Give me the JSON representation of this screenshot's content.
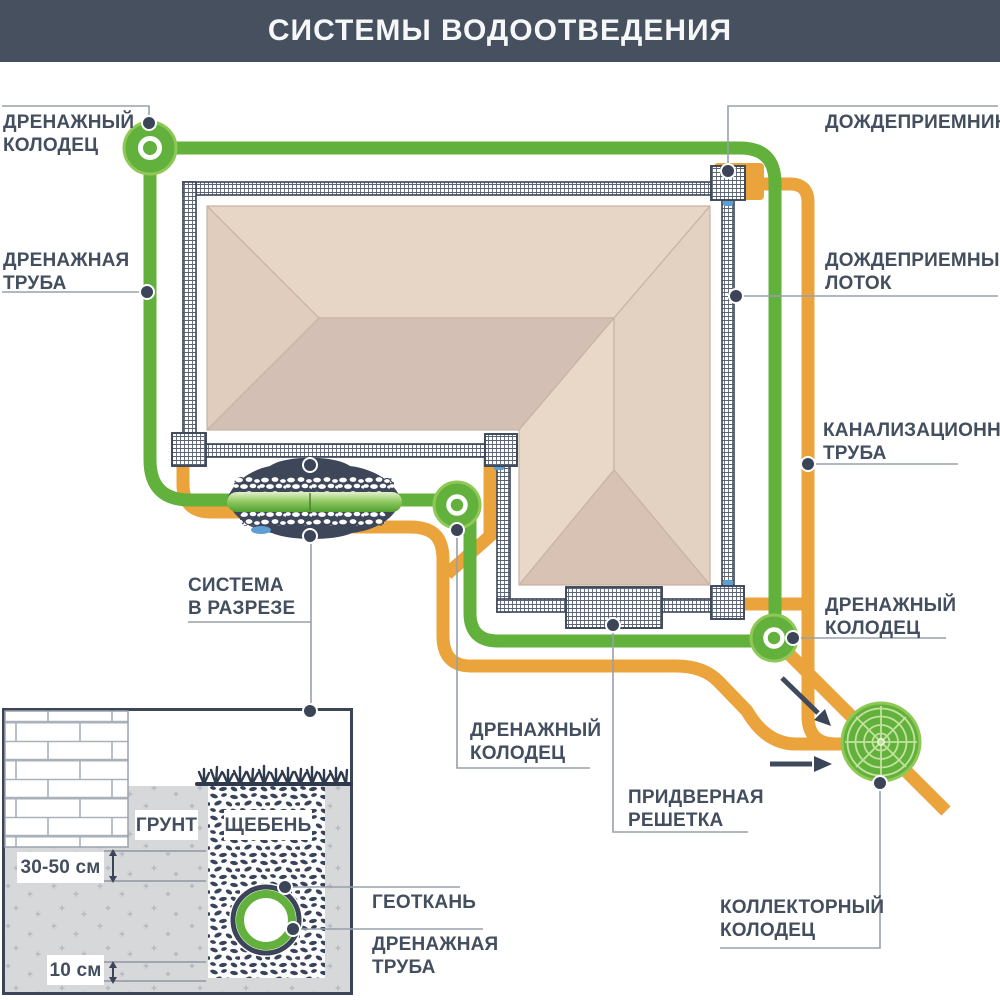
{
  "title": "СИСТЕМЫ ВОДООТВЕДЕНИЯ",
  "labels": {
    "drainage_well_top_left": "ДРЕНАЖНЫЙ\nКОЛОДЕЦ",
    "drainage_pipe_left": "ДРЕНАЖНАЯ\nТРУБА",
    "rain_inlet": "ДОЖДЕПРИЕМНИК",
    "rain_tray": "ДОЖДЕПРИЕМНЫЙ\nЛОТОК",
    "sewer_pipe": "КАНАЛИЗАЦИОННАЯ\nТРУБА",
    "drainage_well_right": "ДРЕНАЖНЫЙ\nКОЛОДЕЦ",
    "system_in_section": "СИСТЕМА\nВ РАЗРЕЗЕ",
    "drainage_well_middle": "ДРЕНАЖНЫЙ\nКОЛОДЕЦ",
    "door_grate": "ПРИДВЕРНАЯ\nРЕШЕТКА",
    "collector_well": "КОЛЛЕКТОРНЫЙ\nКОЛОДЕЦ",
    "soil": "ГРУНТ",
    "gravel": "ЩЕБЕНЬ",
    "geotextile": "ГЕОТКАНЬ",
    "drainage_pipe_section": "ДРЕНАЖНАЯ\nТРУБА",
    "dim_trench_depth": "30-50 см",
    "dim_bedding": "10 см"
  },
  "colors": {
    "header_bg": "#47505e",
    "header_text": "#f5f7f9",
    "drain_green": "#61b13c",
    "green_rim": "#8fc855",
    "sewer_orange": "#eba43c",
    "ink": "#3b4557",
    "label_text": "#434e5e",
    "leader": "#98a0ab",
    "soil_gray": "#d6d8da",
    "water_blue": "#5d9fd3",
    "web_line": "#c3e29e",
    "roof_light": "#e7d5c5",
    "roof_dark": "#d3bfb3"
  }
}
